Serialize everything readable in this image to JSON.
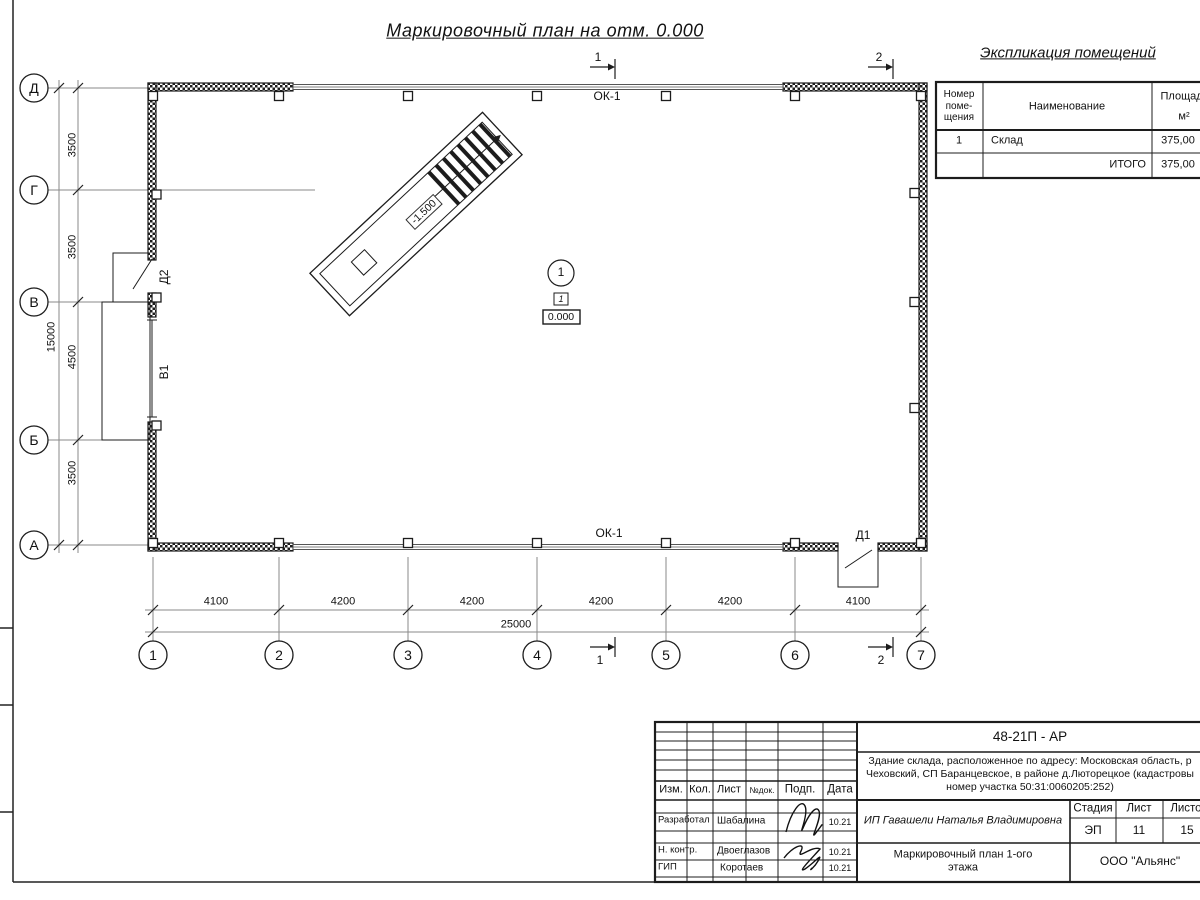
{
  "sheet_title": "Маркировочный план на отм. 0.000",
  "schedule": {
    "title": "Экспликация  помещений",
    "col_number": "Номер\nпоме-\nщения",
    "col_name": "Наименование",
    "col_area1": "Площадь,",
    "col_area2": "м²",
    "row_num": "1",
    "row_name": "Склад",
    "row_area": "375,00",
    "total_label": "ИТОГО",
    "total_value": "375,00"
  },
  "axes": {
    "rows": [
      "Д",
      "Г",
      "В",
      "Б",
      "А"
    ],
    "cols": [
      "1",
      "2",
      "3",
      "4",
      "5",
      "6",
      "7"
    ]
  },
  "dims": {
    "v": [
      "3500",
      "3500",
      "4500",
      "3500"
    ],
    "v_total": "15000",
    "h": [
      "4100",
      "4200",
      "4200",
      "4200",
      "4200",
      "4100"
    ],
    "h_total": "25000"
  },
  "plan": {
    "window_top": "ОК-1",
    "window_bottom": "ОК-1",
    "door_d1": "Д1",
    "door_d2": "Д2",
    "gate_v1": "В1",
    "ramp_level": "-1.500",
    "room_circle": "1",
    "room_tag": "1",
    "level_mark": "0.000"
  },
  "sections": {
    "top1": "1",
    "top2": "2",
    "bottom1": "1",
    "bottom2": "2"
  },
  "tb": {
    "doc_code": "48-21П - АР",
    "desc1": "Здание склада, расположенное по адресу: Московская область, р",
    "desc2": "Чеховский, СП Баранцевское, в районе д.Люторецкое  (кадастровы",
    "desc3": "номер участка 50:31:0060205:252)",
    "col_izm": "Изм.",
    "col_kol": "Кол.",
    "col_list": "Лист",
    "col_ndok": "№док.",
    "col_podp": "Подп.",
    "col_data": "Дата",
    "r1_role": "Разработал",
    "r1_name": "Шабалина",
    "r1_date": "10.21",
    "r2_role": "Н. контр.",
    "r2_name": "Двоеглазов",
    "r2_date": "10.21",
    "r3_role": "ГИП",
    "r3_name": "Коротаев",
    "r3_date": "10.21",
    "client": "ИП Гавашели Наталья Владимировна",
    "stage_label": "Стадия",
    "sheet_label": "Лист",
    "sheets_label": "Листов",
    "stage": "ЭП",
    "sheet_no": "11",
    "sheets_total": "15",
    "drawing_name": "Маркировочный план 1-ого\nэтажа",
    "company": "ООО \"Альянс\""
  }
}
